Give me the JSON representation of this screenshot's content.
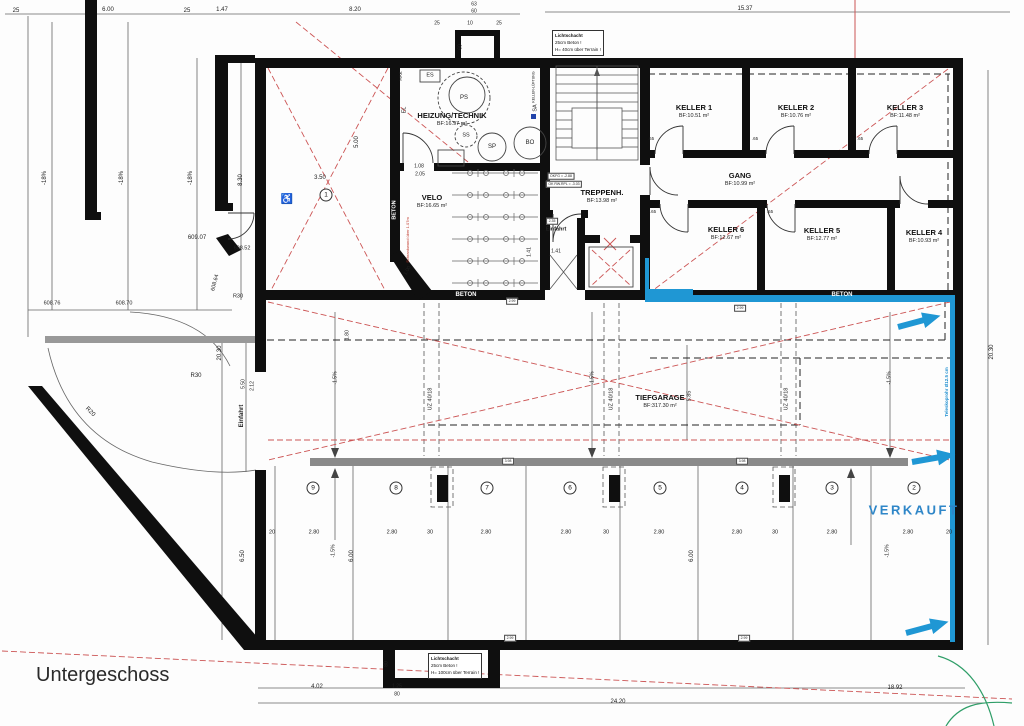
{
  "title": "Untergeschoss",
  "notes": {
    "lichtschacht_top": [
      "Lichtschacht",
      "25cm Beton !",
      "H= 40cm über Terrain !"
    ],
    "lichtschacht_bottom": [
      "Lichtschacht",
      "25cm Beton !",
      "H= 100cm über Terrain !"
    ]
  },
  "colors": {
    "wall": "#0f0f0f",
    "red_dash": "#cc5555",
    "blue": "#1f97d4",
    "verkauft": "#2e86c8",
    "beam_gray": "#8a8a8a",
    "green": "#2f9e68"
  },
  "rooms": [
    {
      "name": "HEIZUNG/TECHNIK",
      "area": "BF:16.97 m²",
      "x": 452,
      "y": 120
    },
    {
      "name": "VELO",
      "area": "BF:16.65 m²",
      "x": 432,
      "y": 202
    },
    {
      "name": "TREPPENH.",
      "area": "BF:13.98 m²",
      "x": 602,
      "y": 197
    },
    {
      "name": "KELLER 1",
      "area": "BF:10.51 m²",
      "x": 694,
      "y": 112
    },
    {
      "name": "KELLER 2",
      "area": "BF:10.76 m²",
      "x": 796,
      "y": 112
    },
    {
      "name": "KELLER 3",
      "area": "BF:11.48 m²",
      "x": 905,
      "y": 112
    },
    {
      "name": "GANG",
      "area": "BF:10.99 m²",
      "x": 740,
      "y": 180
    },
    {
      "name": "KELLER 6",
      "area": "BF:12.67 m²",
      "x": 726,
      "y": 234
    },
    {
      "name": "KELLER 5",
      "area": "BF:12.77 m²",
      "x": 822,
      "y": 235
    },
    {
      "name": "KELLER 4",
      "area": "BF:10.93 m²",
      "x": 924,
      "y": 237
    },
    {
      "name": "TIEFGARAGE",
      "area": "BF:317.30 m²",
      "x": 660,
      "y": 402
    }
  ],
  "parking": {
    "sold_label": "VERKAUFT",
    "spots": [
      {
        "no": "1",
        "x": 326,
        "y": 195
      },
      {
        "no": "9",
        "x": 313,
        "y": 488
      },
      {
        "no": "8",
        "x": 396,
        "y": 488
      },
      {
        "no": "7",
        "x": 487,
        "y": 488
      },
      {
        "no": "6",
        "x": 570,
        "y": 488
      },
      {
        "no": "5",
        "x": 660,
        "y": 488
      },
      {
        "no": "4",
        "x": 742,
        "y": 488
      },
      {
        "no": "3",
        "x": 832,
        "y": 488
      },
      {
        "no": "2",
        "x": 914,
        "y": 488
      }
    ]
  },
  "annotations": [
    {
      "t": "25",
      "x": 16,
      "y": 11
    },
    {
      "t": "6.00",
      "x": 108,
      "y": 10
    },
    {
      "t": "25",
      "x": 187,
      "y": 11
    },
    {
      "t": "1.47",
      "x": 222,
      "y": 10
    },
    {
      "t": "8.20",
      "x": 355,
      "y": 10
    },
    {
      "t": "15.37",
      "x": 745,
      "y": 9
    },
    {
      "t": "63",
      "x": 474,
      "y": 5,
      "s": 5
    },
    {
      "t": "60",
      "x": 474,
      "y": 12,
      "s": 5
    },
    {
      "t": "25",
      "x": 437,
      "y": 24,
      "s": 5
    },
    {
      "t": "10",
      "x": 470,
      "y": 24,
      "s": 5
    },
    {
      "t": "25",
      "x": 499,
      "y": 24,
      "s": 5
    },
    {
      "t": "60",
      "x": 461,
      "y": 47,
      "r": -90,
      "s": 5
    },
    {
      "t": "-18%",
      "x": 45,
      "y": 178,
      "r": -90
    },
    {
      "t": "-18%",
      "x": 122,
      "y": 178,
      "r": -90
    },
    {
      "t": "-18%",
      "x": 191,
      "y": 178,
      "r": -90
    },
    {
      "t": "8.30",
      "x": 241,
      "y": 180,
      "r": -90
    },
    {
      "t": "609.07",
      "x": 197,
      "y": 238
    },
    {
      "t": "608.52",
      "x": 242,
      "y": 249,
      "s": 5.5
    },
    {
      "t": "608.64",
      "x": 216,
      "y": 283,
      "r": -75,
      "s": 5.5
    },
    {
      "t": "R30",
      "x": 238,
      "y": 297,
      "s": 5.5
    },
    {
      "t": "608.76",
      "x": 52,
      "y": 304,
      "s": 5.5
    },
    {
      "t": "608.70",
      "x": 124,
      "y": 304,
      "s": 5.5
    },
    {
      "t": "R30",
      "x": 196,
      "y": 376,
      "s": 6
    },
    {
      "t": "R20",
      "x": 90,
      "y": 412,
      "r": 45,
      "s": 6
    },
    {
      "t": "20.30",
      "x": 220,
      "y": 353,
      "r": -90
    },
    {
      "t": "5.50",
      "x": 244,
      "y": 384,
      "r": -90,
      "s": 5
    },
    {
      "t": "2.12",
      "x": 253,
      "y": 386,
      "r": -90,
      "s": 5
    },
    {
      "t": "Einfahrt",
      "x": 242,
      "y": 416,
      "r": -90,
      "c": "bold"
    },
    {
      "t": "20.30",
      "x": 992,
      "y": 352,
      "r": -90
    },
    {
      "t": "HAK",
      "x": 401,
      "y": 76,
      "r": -90,
      "s": 4.5
    },
    {
      "t": "ES",
      "x": 430,
      "y": 76,
      "s": 5.5
    },
    {
      "t": "EL",
      "x": 405,
      "y": 110,
      "r": -90,
      "s": 5.5
    },
    {
      "t": "PS",
      "x": 464,
      "y": 98,
      "s": 6
    },
    {
      "t": "SS",
      "x": 466,
      "y": 136,
      "s": 5.5
    },
    {
      "t": "SP",
      "x": 492,
      "y": 147,
      "s": 6
    },
    {
      "t": "BO",
      "x": 530,
      "y": 143,
      "s": 6
    },
    {
      "t": "SA",
      "x": 536,
      "y": 108,
      "r": -90,
      "s": 5.5
    },
    {
      "t": "KELLER-LÜFTUNG",
      "x": 534,
      "y": 87,
      "r": -90,
      "s": 3.5
    },
    {
      "t": "1.08",
      "x": 419,
      "y": 167,
      "s": 5
    },
    {
      "t": "2.05",
      "x": 420,
      "y": 175,
      "s": 5
    },
    {
      "t": "3.50",
      "x": 320,
      "y": 178
    },
    {
      "t": "5.00",
      "x": 357,
      "y": 142,
      "r": -90
    },
    {
      "t": "♿",
      "x": 287,
      "y": 200,
      "s": 10
    },
    {
      "t": "BETON",
      "x": 395,
      "y": 210,
      "r": -90,
      "c": "white",
      "s": 5.5
    },
    {
      "t": "BETON",
      "x": 466,
      "y": 295,
      "c": "white"
    },
    {
      "t": "BETON",
      "x": 842,
      "y": 295,
      "c": "white"
    },
    {
      "t": "Schrankwand über 1.07m",
      "x": 408,
      "y": 240,
      "r": -90,
      "c": "red",
      "s": 4
    },
    {
      "t": "1.00",
      "x": 408,
      "y": 271,
      "r": -60,
      "s": 5
    },
    {
      "t": "OKFG = -2.88",
      "x": 561,
      "y": 176,
      "c": "box",
      "s": 3.5
    },
    {
      "t": "OK RW.RPL = -3.03",
      "x": 564,
      "y": 184,
      "c": "box",
      "s": 3.5
    },
    {
      "t": "Einfahrt",
      "x": 556,
      "y": 230,
      "c": "bold",
      "s": 5.5
    },
    {
      "t": "2.35",
      "x": 552,
      "y": 221,
      "c": "box",
      "s": 3.5
    },
    {
      "t": "1.41",
      "x": 556,
      "y": 252,
      "s": 5
    },
    {
      "t": "1.41",
      "x": 530,
      "y": 252,
      "r": -90,
      "s": 5
    },
    {
      "t": ".65",
      "x": 651,
      "y": 139,
      "s": 4.5
    },
    {
      "t": ".65",
      "x": 755,
      "y": 139,
      "s": 4.5
    },
    {
      "t": ".65",
      "x": 860,
      "y": 139,
      "s": 4.5
    },
    {
      "t": ".65",
      "x": 653,
      "y": 212,
      "s": 4.5
    },
    {
      "t": ".65",
      "x": 770,
      "y": 212,
      "s": 4.5
    },
    {
      "t": "UZ 40/18",
      "x": 431,
      "y": 399,
      "r": -90,
      "s": 5.5
    },
    {
      "t": "UZ 40/18",
      "x": 612,
      "y": 399,
      "r": -90,
      "s": 5.5
    },
    {
      "t": "UZ 40/18",
      "x": 787,
      "y": 399,
      "r": -90,
      "s": 5.5
    },
    {
      "t": "5.85",
      "x": 690,
      "y": 396,
      "r": -90,
      "s": 5.5
    },
    {
      "t": "-1.5%",
      "x": 336,
      "y": 378,
      "r": -90,
      "s": 5
    },
    {
      "t": "-1.5%",
      "x": 593,
      "y": 378,
      "r": -90,
      "s": 5
    },
    {
      "t": "-1.5%",
      "x": 890,
      "y": 378,
      "r": -90,
      "s": 5
    },
    {
      "t": "1.80",
      "x": 348,
      "y": 335,
      "r": -90,
      "s": 5
    },
    {
      "t": "2.99",
      "x": 512,
      "y": 301,
      "c": "box",
      "s": 3.5
    },
    {
      "t": "2.99",
      "x": 740,
      "y": 308,
      "c": "box",
      "s": 3.5
    },
    {
      "t": "3.98",
      "x": 508,
      "y": 461,
      "c": "box",
      "s": 3.5
    },
    {
      "t": "3.98",
      "x": 742,
      "y": 461,
      "c": "box",
      "s": 3.5
    },
    {
      "t": "20",
      "x": 272,
      "y": 533,
      "s": 5.5
    },
    {
      "t": "2.80",
      "x": 314,
      "y": 533,
      "s": 5.5
    },
    {
      "t": "2.80",
      "x": 392,
      "y": 533,
      "s": 5.5
    },
    {
      "t": "30",
      "x": 430,
      "y": 533,
      "s": 5.5
    },
    {
      "t": "2.80",
      "x": 486,
      "y": 533,
      "s": 5.5
    },
    {
      "t": "2.80",
      "x": 566,
      "y": 533,
      "s": 5.5
    },
    {
      "t": "30",
      "x": 606,
      "y": 533,
      "s": 5.5
    },
    {
      "t": "2.80",
      "x": 659,
      "y": 533,
      "s": 5.5
    },
    {
      "t": "2.80",
      "x": 737,
      "y": 533,
      "s": 5.5
    },
    {
      "t": "30",
      "x": 775,
      "y": 533,
      "s": 5.5
    },
    {
      "t": "2.80",
      "x": 832,
      "y": 533,
      "s": 5.5
    },
    {
      "t": "2.80",
      "x": 908,
      "y": 533,
      "s": 5.5
    },
    {
      "t": "20",
      "x": 949,
      "y": 533,
      "s": 5.5
    },
    {
      "t": "6.50",
      "x": 243,
      "y": 556,
      "r": -90
    },
    {
      "t": "-1.5%",
      "x": 334,
      "y": 551,
      "r": -90,
      "s": 5
    },
    {
      "t": "6.00",
      "x": 352,
      "y": 556,
      "r": -90
    },
    {
      "t": "6.00",
      "x": 692,
      "y": 556,
      "r": -90
    },
    {
      "t": "-1.5%",
      "x": 888,
      "y": 551,
      "r": -90,
      "s": 5
    },
    {
      "t": "2.99",
      "x": 510,
      "y": 638,
      "c": "box",
      "s": 3.5
    },
    {
      "t": "2.99",
      "x": 744,
      "y": 638,
      "c": "box",
      "s": 3.5
    },
    {
      "t": "VERKAUFT",
      "x": 914,
      "y": 510,
      "c": "verkauft"
    },
    {
      "t": "Teleskoprohr Ø12.5 cm",
      "x": 947,
      "y": 392,
      "r": -90,
      "c": "blue",
      "s": 4.5
    },
    {
      "t": "80",
      "x": 387,
      "y": 664,
      "r": -90,
      "s": 5
    },
    {
      "t": "4.02",
      "x": 317,
      "y": 687
    },
    {
      "t": "1.25",
      "x": 397,
      "y": 687,
      "s": 5
    },
    {
      "t": "80",
      "x": 397,
      "y": 695,
      "s": 5
    },
    {
      "t": "18.92",
      "x": 895,
      "y": 688
    },
    {
      "t": "24.20",
      "x": 618,
      "y": 702
    }
  ]
}
